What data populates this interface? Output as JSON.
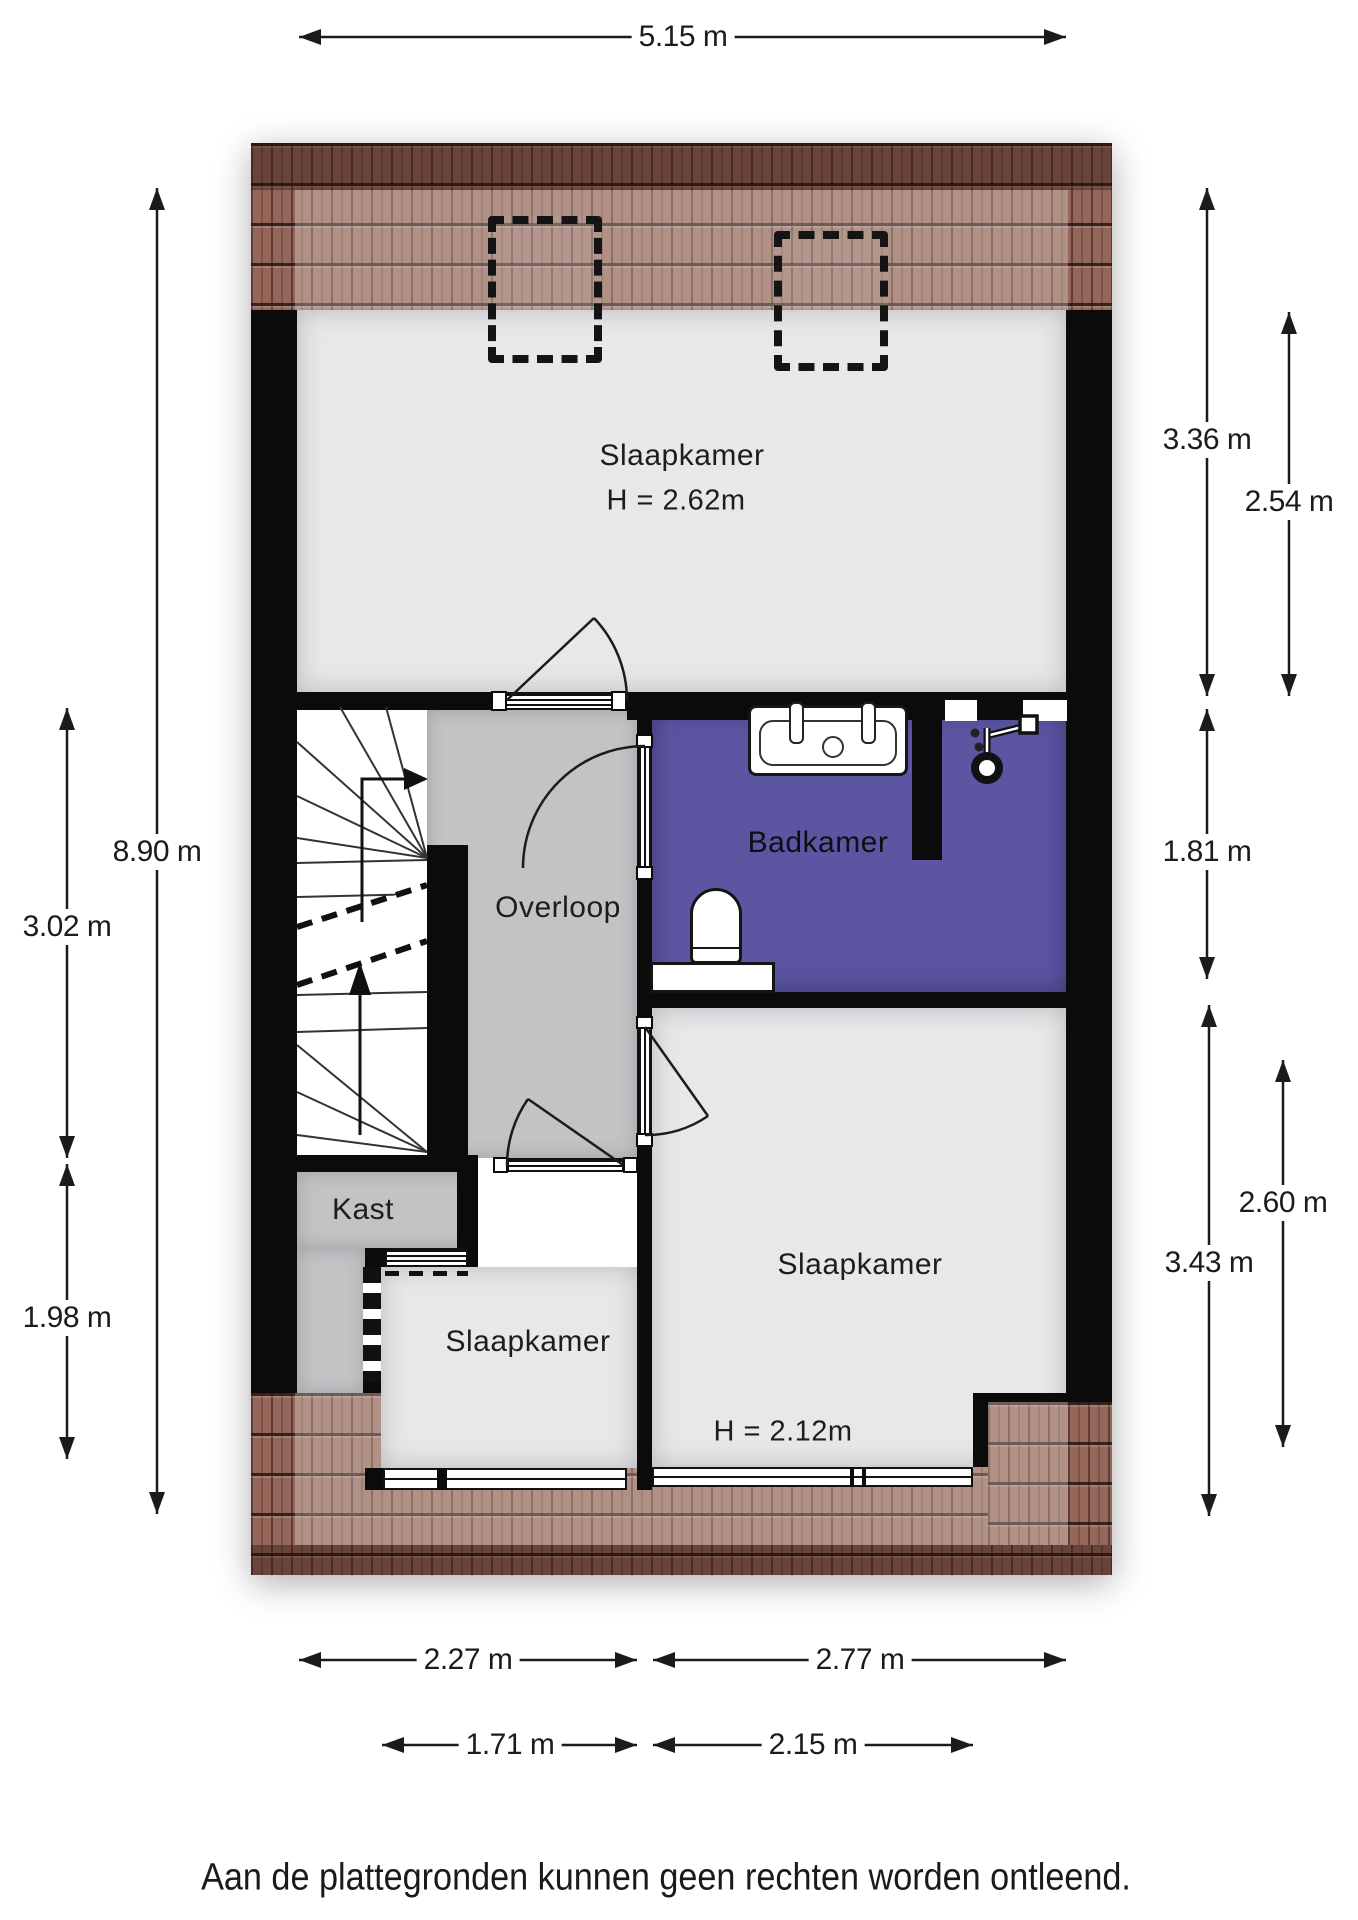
{
  "meta": {
    "type": "floorplan",
    "floor": "verdieping"
  },
  "rooms": [
    {
      "name": "Slaapkamer",
      "ceiling": "H = 2.62m"
    },
    {
      "name": "Badkamer"
    },
    {
      "name": "Overloop"
    },
    {
      "name": "Kast"
    },
    {
      "name": "Slaapkamer"
    },
    {
      "name": "Slaapkamer",
      "ceiling": "H = 2.12m"
    }
  ],
  "dimensions": {
    "top": [
      {
        "label": "5.15 m"
      }
    ],
    "left": [
      {
        "label": "8.90 m"
      },
      {
        "label": "3.02 m"
      },
      {
        "label": "1.98 m"
      }
    ],
    "right": [
      {
        "label": "3.36 m"
      },
      {
        "label": "2.54 m"
      },
      {
        "label": "1.81 m"
      },
      {
        "label": "2.60 m"
      },
      {
        "label": "3.43 m"
      }
    ],
    "bottom": [
      {
        "label": "2.27 m"
      },
      {
        "label": "2.77 m"
      },
      {
        "label": "1.71 m"
      },
      {
        "label": "2.15 m"
      }
    ]
  },
  "fixtures": [
    {
      "name": "double-washbasin"
    },
    {
      "name": "shower"
    },
    {
      "name": "toilet"
    },
    {
      "name": "winder-staircase"
    },
    {
      "name": "skylight-left"
    },
    {
      "name": "skylight-right"
    }
  ],
  "colors": {
    "wall": "#0b0b0b",
    "bedroom_floor": "#e8e8ea",
    "landing_floor": "#c3c3c5",
    "bathroom_floor": "#5b55a2",
    "roof_tile": "#95675a",
    "dimension_line": "#1b1b1b"
  },
  "footer": {
    "disclaimer": "Aan de plattegronden kunnen geen rechten worden ontleend."
  }
}
